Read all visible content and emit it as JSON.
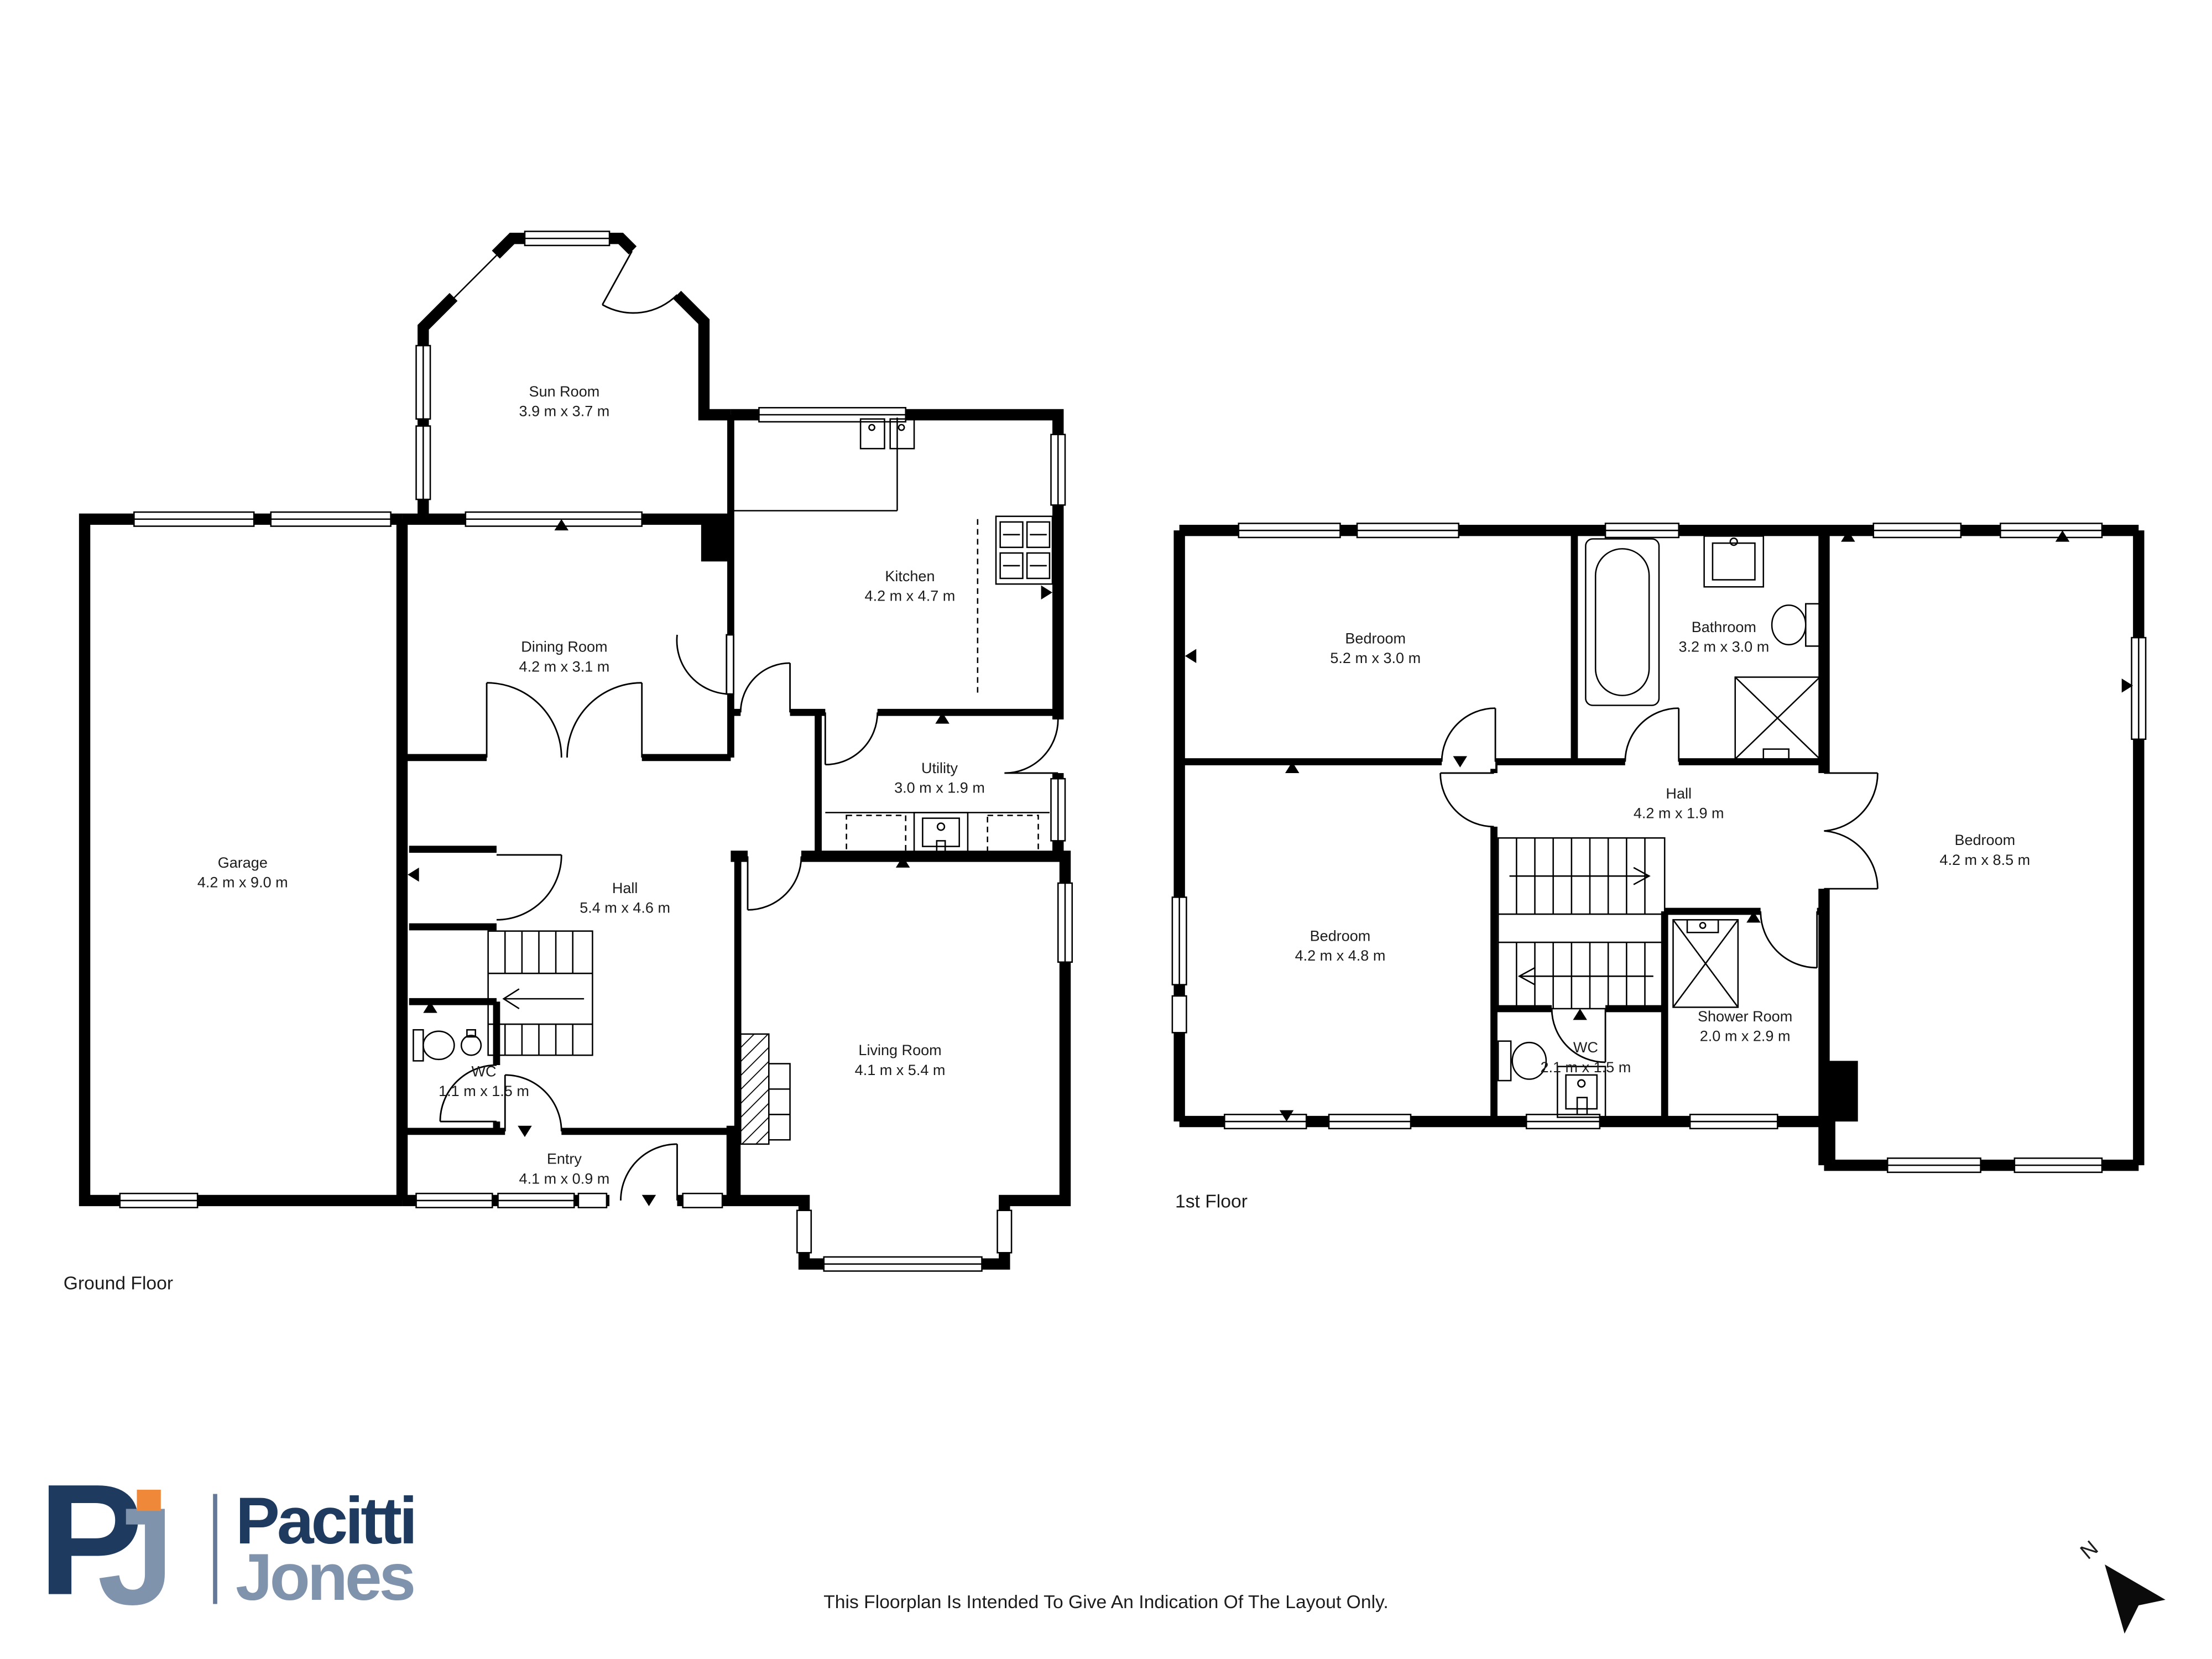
{
  "brand": {
    "mark_letter_p": "P",
    "mark_letter_j": "J",
    "name_line1": "Pacitti",
    "name_line2": "Jones"
  },
  "colors": {
    "brand_navy": "#1e3a5f",
    "brand_steel": "#8093ac",
    "brand_orange": "#f0883a",
    "wall": "#000000",
    "label_text": "#1c1c1c"
  },
  "footer_note": "This Floorplan Is Intended To Give An Indication Of The Layout Only.",
  "north_label": "N",
  "floors": [
    {
      "label": "Ground Floor",
      "rooms": [
        {
          "name": "Sun Room",
          "dims": "3.9 m x 3.7 m"
        },
        {
          "name": "Dining Room",
          "dims": "4.2 m x 3.1 m"
        },
        {
          "name": "Kitchen",
          "dims": "4.2 m x 4.7 m"
        },
        {
          "name": "Utility",
          "dims": "3.0 m x 1.9 m"
        },
        {
          "name": "Garage",
          "dims": "4.2 m x 9.0 m"
        },
        {
          "name": "Hall",
          "dims": "5.4 m x 4.6 m"
        },
        {
          "name": "WC",
          "dims": "1.1 m x 1.5 m"
        },
        {
          "name": "Entry",
          "dims": "4.1 m x 0.9 m"
        },
        {
          "name": "Living Room",
          "dims": "4.1 m x 5.4 m"
        }
      ]
    },
    {
      "label": "1st Floor",
      "rooms": [
        {
          "name": "Bedroom",
          "dims": "5.2 m x 3.0 m"
        },
        {
          "name": "Bathroom",
          "dims": "3.2 m x 3.0 m"
        },
        {
          "name": "Hall",
          "dims": "4.2 m x 1.9 m"
        },
        {
          "name": "Bedroom",
          "dims": "4.2 m x 4.8 m"
        },
        {
          "name": "WC",
          "dims": "2.1 m x 1.5 m"
        },
        {
          "name": "Shower Room",
          "dims": "2.0 m x 2.9 m"
        },
        {
          "name": "Bedroom",
          "dims": "4.2 m x 8.5 m"
        }
      ]
    }
  ]
}
